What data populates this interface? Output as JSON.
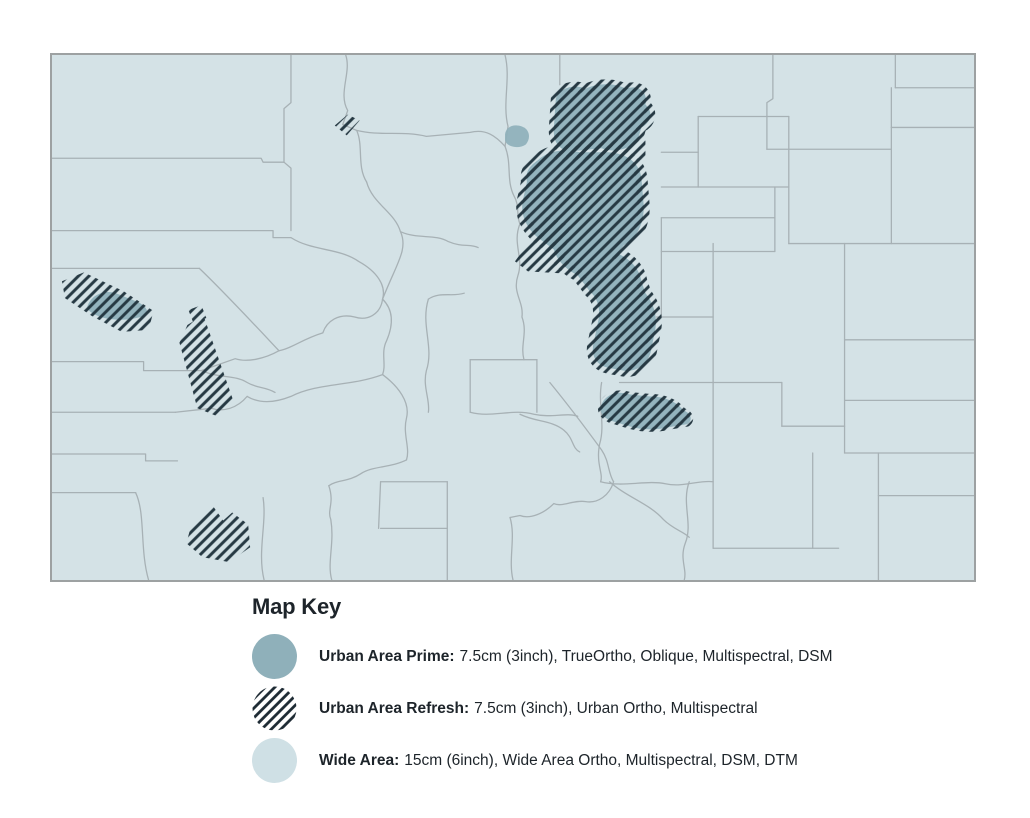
{
  "map": {
    "region": "colorado-county-coverage-map",
    "colors": {
      "wide_area_fill": "#d4e2e6",
      "urban_prime_fill": "#8fb0ba",
      "refresh_hatch": "#263943",
      "county_line": "#a7b1b5",
      "map_border": "#9da1a2",
      "legend_wide_area_fill": "#cfe0e5",
      "legend_hatch": "#1d2a33",
      "text": "#1d242a"
    }
  },
  "legend": {
    "title": "Map Key",
    "items": [
      {
        "id": "urban-area-prime",
        "swatch": "solid-teal-circle",
        "label": "Urban Area Prime:",
        "description": "7.5cm (3inch), TrueOrtho, Oblique, Multispectral, DSM"
      },
      {
        "id": "urban-area-refresh",
        "swatch": "hatched-circle",
        "label": "Urban Area Refresh:",
        "description": "7.5cm (3inch), Urban Ortho, Multispectral"
      },
      {
        "id": "wide-area",
        "swatch": "light-blue-circle",
        "label": "Wide Area:",
        "description": "15cm (6inch), Wide Area Ortho, Multispectral, DSM, DTM"
      }
    ]
  }
}
